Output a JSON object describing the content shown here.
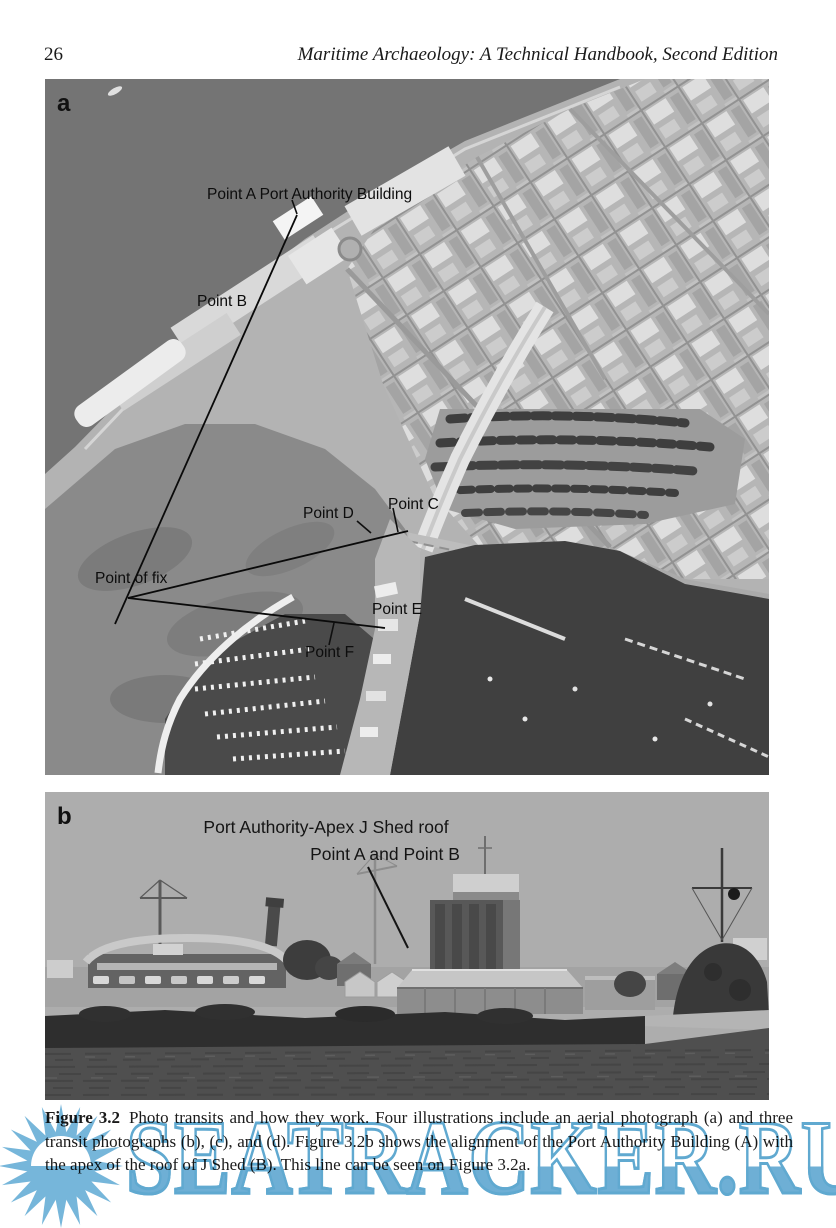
{
  "page": {
    "number": "26",
    "running_title": "Maritime Archaeology: A Technical Handbook, Second Edition"
  },
  "figure": {
    "panel_a": {
      "label": "a",
      "annotations": {
        "point_a": "Point A  Port Authority Building",
        "point_b": "Point B",
        "point_c": "Point C",
        "point_d": "Point D",
        "point_e": "Point E",
        "point_f": "Point F",
        "point_of_fix": "Point of fix"
      }
    },
    "panel_b": {
      "label": "b",
      "annotation_line1": "Port Authority-Apex J Shed roof",
      "annotation_line2": "Point A and  Point B"
    },
    "caption": {
      "label": "Figure 3.2",
      "body": "Photo transits and how they work. Four illustrations include an aerial photograph (a) and three transit photographs (b), (c), and (d). Figure 3.2b shows the alignment of the Port Authority Building (A) with the apex of the roof of J Shed (B). This line can be seen on Figure 3.2a."
    }
  },
  "watermark": {
    "text": "SEATRACKER.RU",
    "color": "#66abd3"
  }
}
